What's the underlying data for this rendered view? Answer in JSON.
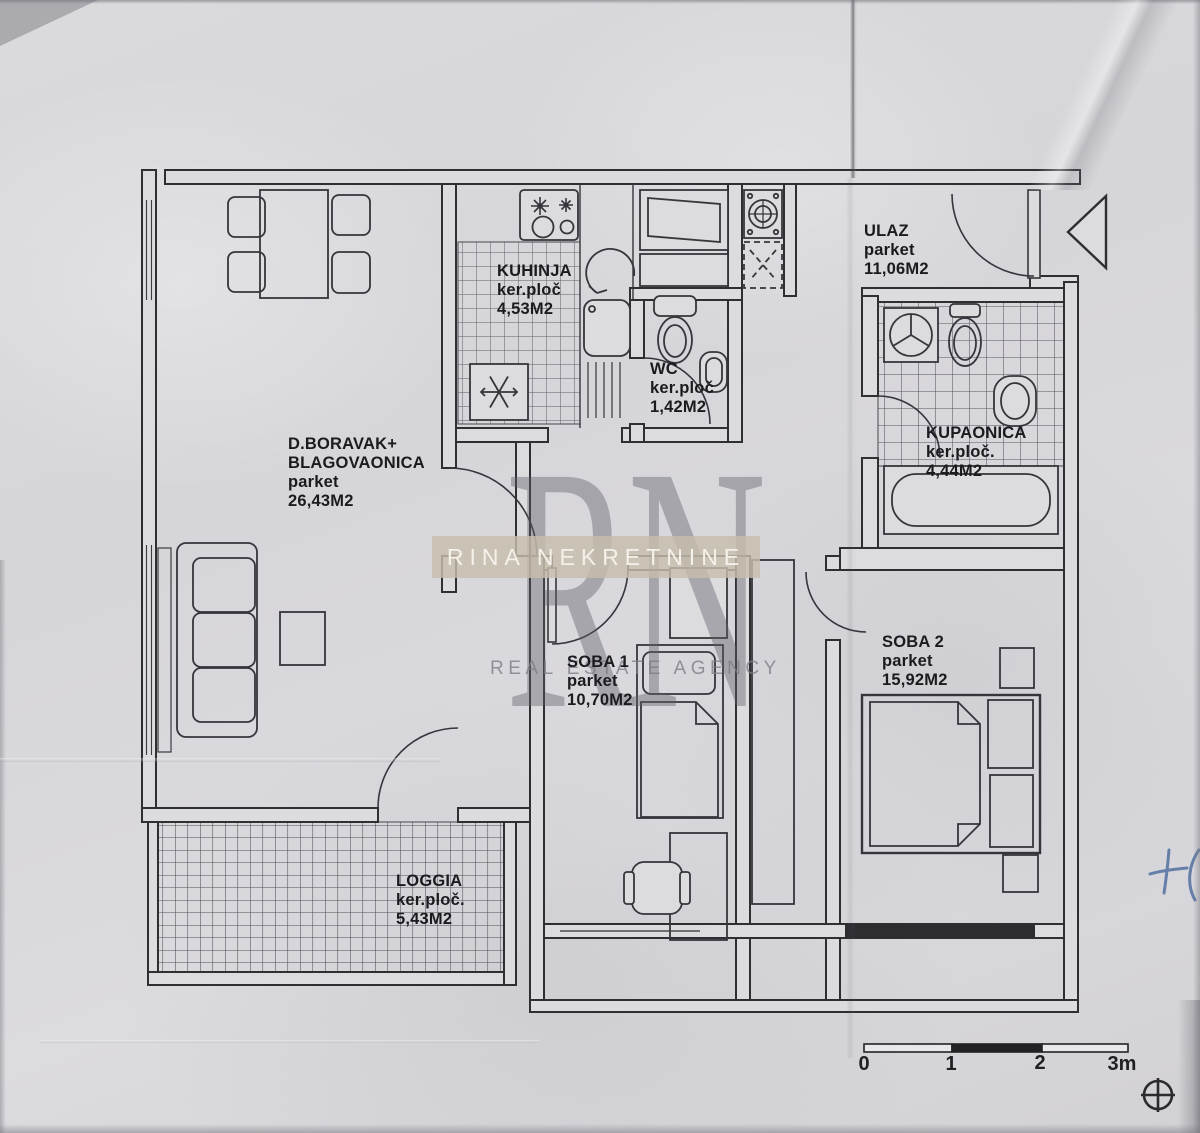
{
  "watermark": {
    "monogram": "RN",
    "agency_name": "RINA NEKRETNINE",
    "tagline": "REAL ESTATE AGENCY",
    "band_color": "#c7bdab"
  },
  "rooms": {
    "living": {
      "name": "D.BORAVAK+",
      "name2": "BLAGOVAONICA",
      "floor": "parket",
      "area": "26,43M2"
    },
    "kitchen": {
      "name": "KUHINJA",
      "floor": "ker.ploč",
      "area": "4,53M2"
    },
    "wc": {
      "name": "WC",
      "floor": "ker.ploč",
      "area": "1,42M2"
    },
    "entry": {
      "name": "ULAZ",
      "floor": "parket",
      "area": "11,06M2"
    },
    "bathroom": {
      "name": "KUPAONICA",
      "floor": "ker.ploč.",
      "area": "4,44M2"
    },
    "room1": {
      "name": "SOBA 1",
      "floor": "parket",
      "area": "10,70M2"
    },
    "room2": {
      "name": "SOBA 2",
      "floor": "parket",
      "area": "15,92M2"
    },
    "loggia": {
      "name": "LOGGIA",
      "floor": "ker.ploč.",
      "area": "5,43M2"
    }
  },
  "scale_bar": {
    "ticks": [
      "0",
      "1",
      "2",
      "3m"
    ]
  },
  "handwritten_note": "+ (",
  "icons": {
    "fridge": "snowflake-icon",
    "shaft": "x-cross-icon",
    "entrance": "entrance-arrow-icon",
    "survey_marker": "crosshair-icon",
    "kitchen_arrow": "rotation-arrow-icon"
  },
  "colors": {
    "paper": "#d9d8db",
    "ink": "#2e2e33",
    "watermark_text": "#f4f1ea",
    "pen": "#4a6a9d"
  }
}
